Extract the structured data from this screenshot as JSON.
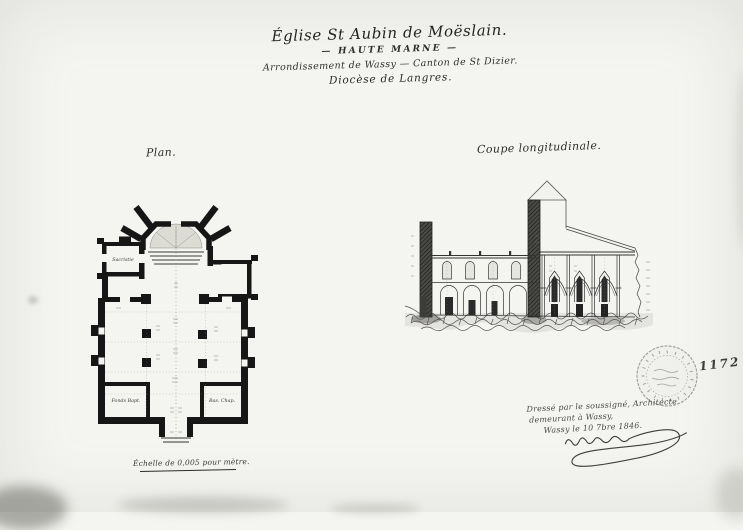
{
  "title_block": {
    "line1": "Église St Aubin de Moëslain.",
    "line2": "— HAUTE MARNE —",
    "line3": "Arrondissement de Wassy — Canton de St Dizier.",
    "line4": "Diocèse de Langres."
  },
  "plan": {
    "label": "Plan.",
    "rooms": {
      "sacristie": "Sacristie",
      "fonts": "Fonds Bapt.",
      "chapelle": "Bas. Chap."
    }
  },
  "section": {
    "label": "Coupe longitudinale."
  },
  "signature_block": {
    "line1": "Dressé par le soussigné, Architecte",
    "line2": "demeurant à Wassy,",
    "line3": "Wassy le 10 7bre 1846."
  },
  "notes": {
    "scale": "Échelle de 0,005 pour mètre.",
    "inventory_number": "1172"
  }
}
